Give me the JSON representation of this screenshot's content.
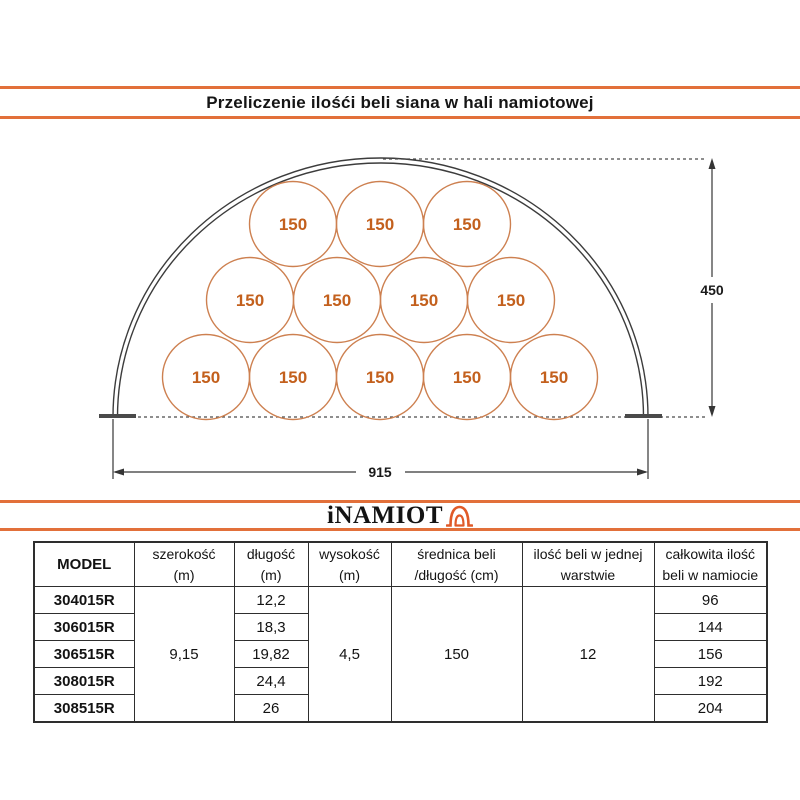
{
  "title": "Przeliczenie ilośći beli siana w hali namiotowej",
  "colors": {
    "accent_orange": "#e2703a",
    "logo_icon_orange": "#e05a28",
    "bale_stroke": "#cd8050",
    "bale_text": "#c3601d",
    "drawing_line": "#3c3c3c"
  },
  "diagram": {
    "bale_label": "150",
    "bale_rows": [
      3,
      4,
      5
    ],
    "bale_count": 12,
    "height_dim": "450",
    "width_dim": "915"
  },
  "logo": {
    "text": "iNAMIOT",
    "icon": "tent-arch-icon"
  },
  "table": {
    "headers": [
      {
        "line1": "MODEL",
        "line2": ""
      },
      {
        "line1": "szerokość",
        "line2": "(m)"
      },
      {
        "line1": "długość",
        "line2": "(m)"
      },
      {
        "line1": "wysokość",
        "line2": "(m)"
      },
      {
        "line1": "średnica beli",
        "line2": "/długość (cm)"
      },
      {
        "line1": "ilość beli w jednej",
        "line2": "warstwie"
      },
      {
        "line1": "całkowita ilość",
        "line2": "beli w namiocie"
      }
    ],
    "merged": {
      "szerokosc": "9,15",
      "wysokosc": "4,5",
      "srednica": "150",
      "ilosc_warstwa": "12"
    },
    "rows": [
      {
        "model": "304015R",
        "dlugosc": "12,2",
        "total": "96"
      },
      {
        "model": "306015R",
        "dlugosc": "18,3",
        "total": "144"
      },
      {
        "model": "306515R",
        "dlugosc": "19,82",
        "total": "156"
      },
      {
        "model": "308015R",
        "dlugosc": "24,4",
        "total": "192"
      },
      {
        "model": "308515R",
        "dlugosc": "26",
        "total": "204"
      }
    ]
  }
}
